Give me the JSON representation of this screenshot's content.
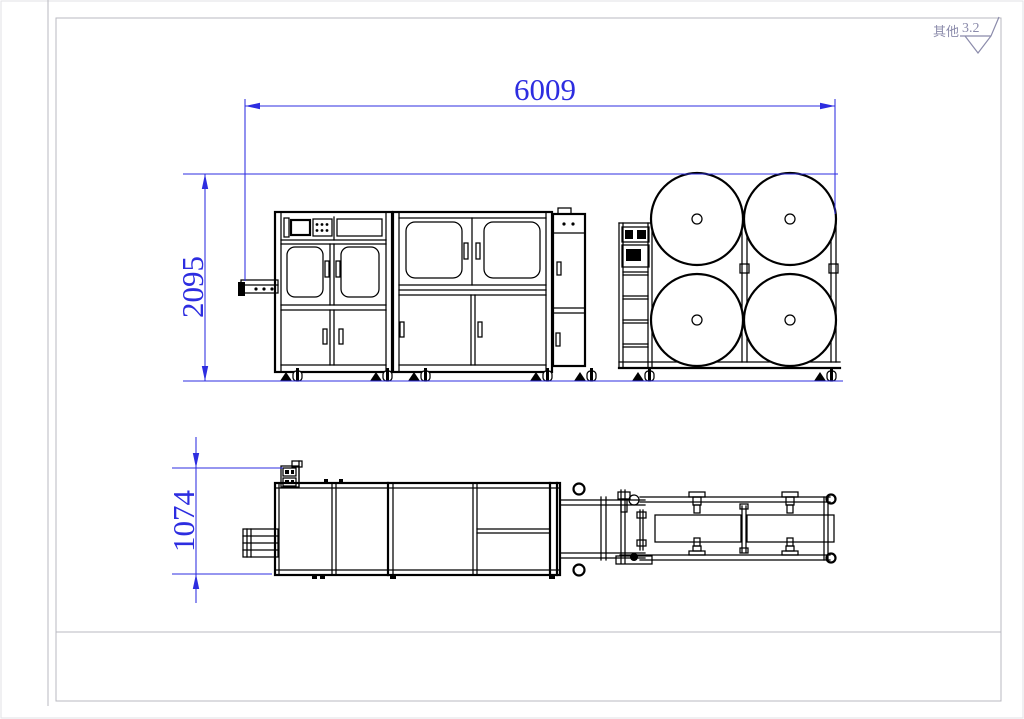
{
  "sheet": {
    "colors": {
      "machine_line": "#000000",
      "dimension_blue": "#2d2de0",
      "frame_gray": "#b9b9c0",
      "note_gray": "#8b8bab"
    },
    "roughness_note": {
      "prefix_label": "其他",
      "value": "3.2",
      "icon": "surface-roughness-icon"
    }
  },
  "dimensions": {
    "overall_length": "6009",
    "overall_height": "2095",
    "overall_depth": "1074"
  }
}
